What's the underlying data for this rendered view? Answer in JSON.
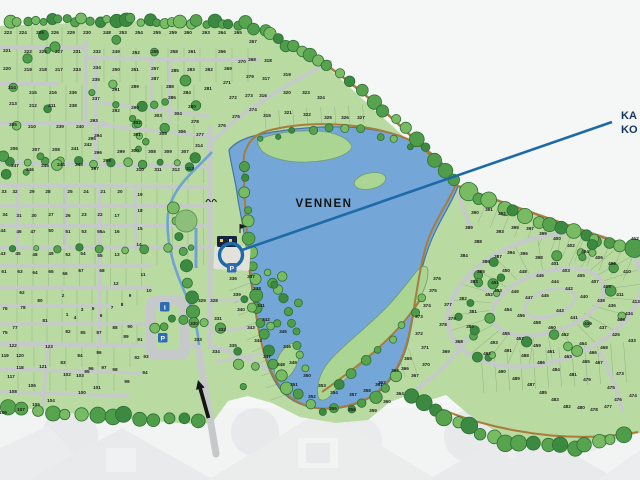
{
  "labels": {
    "lake": "VENNEN",
    "callout_line1": "KA",
    "callout_line2": "KO"
  },
  "icons": {
    "parking": "P",
    "info": "i"
  },
  "colors": {
    "bg": "#f5f6f6",
    "land": "#b9dba2",
    "island": "#abd593",
    "lake": "#74a7d8",
    "lake_edge": "#46749f",
    "road": "#c6c9ca",
    "path": "#a87c3c",
    "tree_dark": "#3c8a41",
    "tree_mid": "#57a34e",
    "tree_light": "#79bb63",
    "tree_edge": "#2d7034",
    "callout_line": "#1d6aa6",
    "navy_text": "#14365e",
    "badge_blue": "#2d6cb5",
    "number_text": "#1d1d1d",
    "photo": "#e3e6e7"
  },
  "plots": [
    [
      "223",
      8,
      34
    ],
    [
      "224",
      23,
      34
    ],
    [
      "225",
      40,
      34
    ],
    [
      "226",
      55,
      34
    ],
    [
      "229",
      71,
      34
    ],
    [
      "230",
      87,
      34
    ],
    [
      "248",
      107,
      34
    ],
    [
      "253",
      123,
      34
    ],
    [
      "254",
      139,
      34
    ],
    [
      "255",
      157,
      34
    ],
    [
      "259",
      173,
      34
    ],
    [
      "260",
      188,
      34
    ],
    [
      "263",
      206,
      34
    ],
    [
      "264",
      222,
      34
    ],
    [
      "265",
      238,
      34
    ],
    [
      "221",
      7,
      52
    ],
    [
      "222",
      28,
      53
    ],
    [
      "226",
      43,
      53
    ],
    [
      "227",
      59,
      53
    ],
    [
      "231",
      77,
      53
    ],
    [
      "232",
      97,
      53
    ],
    [
      "249",
      116,
      53
    ],
    [
      "252",
      136,
      54
    ],
    [
      "256",
      155,
      53
    ],
    [
      "258",
      174,
      53
    ],
    [
      "261",
      192,
      53
    ],
    [
      "266",
      222,
      53
    ],
    [
      "267",
      253,
      43
    ],
    [
      "268",
      252,
      61
    ],
    [
      "318",
      268,
      62
    ],
    [
      "220",
      7,
      70
    ],
    [
      "219",
      28,
      71
    ],
    [
      "218",
      43,
      71
    ],
    [
      "217",
      59,
      71
    ],
    [
      "233",
      77,
      71
    ],
    [
      "234",
      97,
      69
    ],
    [
      "250",
      116,
      71
    ],
    [
      "251",
      135,
      71
    ],
    [
      "257",
      155,
      70
    ],
    [
      "285",
      175,
      72
    ],
    [
      "283",
      191,
      71
    ],
    [
      "282",
      209,
      71
    ],
    [
      "269",
      228,
      70
    ],
    [
      "270",
      242,
      63
    ],
    [
      "279",
      250,
      78
    ],
    [
      "317",
      266,
      80
    ],
    [
      "319",
      287,
      76
    ],
    [
      "214",
      12,
      89
    ],
    [
      "215",
      33,
      94
    ],
    [
      "216",
      53,
      94
    ],
    [
      "236",
      73,
      94
    ],
    [
      "235",
      96,
      81
    ],
    [
      "291",
      116,
      91
    ],
    [
      "289",
      135,
      88
    ],
    [
      "287",
      155,
      80
    ],
    [
      "288",
      170,
      88
    ],
    [
      "284",
      187,
      94
    ],
    [
      "281",
      208,
      90
    ],
    [
      "271",
      227,
      84
    ],
    [
      "272",
      233,
      99
    ],
    [
      "273",
      249,
      97
    ],
    [
      "316",
      263,
      97
    ],
    [
      "320",
      287,
      94
    ],
    [
      "323",
      306,
      94
    ],
    [
      "324",
      321,
      99
    ],
    [
      "213",
      13,
      105
    ],
    [
      "212",
      33,
      107
    ],
    [
      "211",
      52,
      107
    ],
    [
      "238",
      73,
      107
    ],
    [
      "237",
      96,
      100
    ],
    [
      "292",
      116,
      112
    ],
    [
      "290",
      135,
      109
    ],
    [
      "286",
      172,
      99
    ],
    [
      "302",
      137,
      124
    ],
    [
      "303",
      158,
      117
    ],
    [
      "304",
      178,
      115
    ],
    [
      "280",
      192,
      108
    ],
    [
      "278",
      195,
      123
    ],
    [
      "274",
      253,
      111
    ],
    [
      "275",
      236,
      118
    ],
    [
      "276",
      222,
      127
    ],
    [
      "315",
      267,
      117
    ],
    [
      "321",
      288,
      114
    ],
    [
      "322",
      307,
      116
    ],
    [
      "325",
      328,
      119
    ],
    [
      "326",
      345,
      119
    ],
    [
      "327",
      361,
      119
    ],
    [
      "205",
      13,
      126
    ],
    [
      "210",
      32,
      128
    ],
    [
      "239",
      60,
      128
    ],
    [
      "240",
      80,
      128
    ],
    [
      "293",
      94,
      122
    ],
    [
      "294",
      98,
      137
    ],
    [
      "301",
      137,
      136
    ],
    [
      "305",
      163,
      135
    ],
    [
      "306",
      182,
      133
    ],
    [
      "277",
      200,
      136
    ],
    [
      "206",
      14,
      150
    ],
    [
      "207",
      36,
      151
    ],
    [
      "208",
      56,
      151
    ],
    [
      "241",
      75,
      150
    ],
    [
      "242",
      88,
      146
    ],
    [
      "296",
      98,
      154
    ],
    [
      "295",
      92,
      140
    ],
    [
      "299",
      121,
      153
    ],
    [
      "300",
      135,
      152
    ],
    [
      "308",
      152,
      153
    ],
    [
      "309",
      168,
      153
    ],
    [
      "307",
      185,
      153
    ],
    [
      "314",
      199,
      147
    ],
    [
      "247",
      15,
      167
    ],
    [
      "246",
      30,
      171
    ],
    [
      "245",
      45,
      167
    ],
    [
      "244",
      61,
      166
    ],
    [
      "243",
      79,
      166
    ],
    [
      "297",
      95,
      170
    ],
    [
      "298",
      107,
      162
    ],
    [
      "310",
      140,
      171
    ],
    [
      "311",
      158,
      171
    ],
    [
      "312",
      176,
      171
    ],
    [
      "313",
      190,
      170
    ],
    [
      "33",
      4,
      193
    ],
    [
      "32",
      15,
      193
    ],
    [
      "29",
      32,
      193
    ],
    [
      "28",
      48,
      193
    ],
    [
      "25",
      70,
      193
    ],
    [
      "24",
      86,
      193
    ],
    [
      "21",
      103,
      193
    ],
    [
      "20",
      120,
      193
    ],
    [
      "19",
      140,
      196
    ],
    [
      "34",
      5,
      216
    ],
    [
      "31",
      19,
      217
    ],
    [
      "30",
      34,
      217
    ],
    [
      "27",
      51,
      216
    ],
    [
      "26",
      68,
      217
    ],
    [
      "23",
      84,
      216
    ],
    [
      "22",
      100,
      216
    ],
    [
      "17",
      117,
      217
    ],
    [
      "18",
      140,
      212
    ],
    [
      "44",
      3,
      232
    ],
    [
      "46",
      19,
      233
    ],
    [
      "47",
      33,
      233
    ],
    [
      "50",
      51,
      232
    ],
    [
      "51",
      68,
      233
    ],
    [
      "53",
      84,
      233
    ],
    [
      "55a",
      101,
      233
    ],
    [
      "16",
      117,
      233
    ],
    [
      "15",
      140,
      230
    ],
    [
      "43",
      3,
      255
    ],
    [
      "45",
      18,
      255
    ],
    [
      "48",
      35,
      256
    ],
    [
      "49",
      51,
      255
    ],
    [
      "52",
      68,
      256
    ],
    [
      "54",
      83,
      255
    ],
    [
      "55",
      100,
      257
    ],
    [
      "13",
      117,
      256
    ],
    [
      "14",
      139,
      246
    ],
    [
      "61",
      4,
      273
    ],
    [
      "63",
      20,
      273
    ],
    [
      "64",
      35,
      274
    ],
    [
      "65",
      51,
      273
    ],
    [
      "66",
      65,
      275
    ],
    [
      "67",
      81,
      272
    ],
    [
      "68",
      102,
      272
    ],
    [
      "12",
      116,
      285
    ],
    [
      "11",
      143,
      276
    ],
    [
      "10",
      149,
      292
    ],
    [
      "62",
      22,
      294
    ],
    [
      "2",
      63,
      297
    ],
    [
      "80",
      40,
      302
    ],
    [
      "9",
      130,
      297
    ],
    [
      "8",
      122,
      306
    ],
    [
      "76",
      5,
      310
    ],
    [
      "78",
      23,
      309
    ],
    [
      "1",
      67,
      316
    ],
    [
      "3",
      82,
      311
    ],
    [
      "5",
      93,
      310
    ],
    [
      "4",
      75,
      319
    ],
    [
      "6",
      101,
      317
    ],
    [
      "7",
      112,
      309
    ],
    [
      "81",
      45,
      322
    ],
    [
      "77",
      15,
      329
    ],
    [
      "75",
      5,
      334
    ],
    [
      "82",
      68,
      333
    ],
    [
      "85",
      83,
      334
    ],
    [
      "87",
      99,
      334
    ],
    [
      "88",
      115,
      329
    ],
    [
      "90",
      130,
      328
    ],
    [
      "91",
      140,
      341
    ],
    [
      "89",
      126,
      338
    ],
    [
      "122",
      13,
      347
    ],
    [
      "123",
      49,
      348
    ],
    [
      "119",
      5,
      357
    ],
    [
      "120",
      20,
      357
    ],
    [
      "118",
      20,
      369
    ],
    [
      "121",
      43,
      368
    ],
    [
      "117",
      11,
      378
    ],
    [
      "86",
      99,
      354
    ],
    [
      "84",
      80,
      357
    ],
    [
      "83",
      63,
      364
    ],
    [
      "96",
      91,
      370
    ],
    [
      "97",
      104,
      369
    ],
    [
      "92",
      137,
      359
    ],
    [
      "93",
      146,
      358
    ],
    [
      "95",
      87,
      373
    ],
    [
      "94",
      145,
      374
    ],
    [
      "98",
      115,
      371
    ],
    [
      "99",
      127,
      383
    ],
    [
      "100",
      82,
      394
    ],
    [
      "101",
      97,
      389
    ],
    [
      "102",
      67,
      376
    ],
    [
      "103",
      80,
      377
    ],
    [
      "104",
      51,
      402
    ],
    [
      "105",
      36,
      406
    ],
    [
      "106",
      32,
      387
    ],
    [
      "107",
      21,
      411
    ],
    [
      "108",
      13,
      393
    ],
    [
      "109",
      3,
      414
    ],
    [
      "336",
      233,
      280
    ],
    [
      "337",
      251,
      278
    ],
    [
      "338",
      257,
      290
    ],
    [
      "339",
      237,
      296
    ],
    [
      "329",
      202,
      302
    ],
    [
      "328",
      214,
      302
    ],
    [
      "330",
      194,
      325
    ],
    [
      "331",
      218,
      320
    ],
    [
      "332",
      222,
      331
    ],
    [
      "333",
      198,
      341
    ],
    [
      "334",
      216,
      353
    ],
    [
      "335",
      233,
      347
    ],
    [
      "340",
      241,
      311
    ],
    [
      "341",
      261,
      307
    ],
    [
      "342",
      266,
      321
    ],
    [
      "343",
      251,
      329
    ],
    [
      "344",
      258,
      342
    ],
    [
      "345",
      283,
      333
    ],
    [
      "346",
      287,
      348
    ],
    [
      "347",
      267,
      358
    ],
    [
      "348",
      281,
      366
    ],
    [
      "349",
      293,
      364
    ],
    [
      "350",
      307,
      377
    ],
    [
      "351",
      294,
      386
    ],
    [
      "352",
      312,
      398
    ],
    [
      "353",
      322,
      387
    ],
    [
      "354",
      334,
      394
    ],
    [
      "355",
      333,
      410
    ],
    [
      "356",
      352,
      411
    ],
    [
      "357",
      353,
      396
    ],
    [
      "358",
      367,
      392
    ],
    [
      "359",
      373,
      412
    ],
    [
      "360",
      387,
      403
    ],
    [
      "361",
      379,
      386
    ],
    [
      "362",
      382,
      384
    ],
    [
      "363",
      395,
      372
    ],
    [
      "364",
      400,
      395
    ],
    [
      "365",
      408,
      360
    ],
    [
      "366",
      405,
      370
    ],
    [
      "367",
      415,
      377
    ],
    [
      "368",
      459,
      343
    ],
    [
      "369",
      446,
      353
    ],
    [
      "370",
      426,
      366
    ],
    [
      "371",
      425,
      349
    ],
    [
      "372",
      419,
      335
    ],
    [
      "373",
      419,
      318
    ],
    [
      "374",
      427,
      307
    ],
    [
      "375",
      433,
      292
    ],
    [
      "376",
      437,
      280
    ],
    [
      "377",
      448,
      306
    ],
    [
      "378",
      443,
      326
    ],
    [
      "379",
      452,
      320
    ],
    [
      "380",
      470,
      328
    ],
    [
      "381",
      473,
      313
    ],
    [
      "382",
      463,
      300
    ],
    [
      "383",
      474,
      283
    ],
    [
      "384",
      464,
      257
    ],
    [
      "385",
      481,
      273
    ],
    [
      "386",
      486,
      263
    ],
    [
      "387",
      498,
      258
    ],
    [
      "388",
      478,
      243
    ],
    [
      "389",
      469,
      229
    ],
    [
      "390",
      475,
      214
    ],
    [
      "391",
      489,
      211
    ],
    [
      "392",
      502,
      215
    ],
    [
      "393",
      500,
      233
    ],
    [
      "394",
      511,
      254
    ],
    [
      "395",
      515,
      229
    ],
    [
      "396",
      524,
      255
    ],
    [
      "397",
      530,
      230
    ],
    [
      "398",
      539,
      259
    ],
    [
      "399",
      543,
      235
    ],
    [
      "400",
      557,
      240
    ],
    [
      "401",
      555,
      265
    ],
    [
      "402",
      571,
      247
    ],
    [
      "403",
      566,
      272
    ],
    [
      "404",
      585,
      253
    ],
    [
      "405",
      581,
      277
    ],
    [
      "406",
      599,
      259
    ],
    [
      "407",
      595,
      283
    ],
    [
      "408",
      612,
      265
    ],
    [
      "409",
      607,
      288
    ],
    [
      "410",
      627,
      273
    ],
    [
      "411",
      620,
      296
    ],
    [
      "412",
      635,
      240
    ],
    [
      "413",
      636,
      303
    ],
    [
      "425",
      616,
      336
    ],
    [
      "433",
      632,
      342
    ],
    [
      "434",
      629,
      315
    ],
    [
      "435",
      621,
      321
    ],
    [
      "436",
      612,
      307
    ],
    [
      "437",
      603,
      329
    ],
    [
      "438",
      601,
      302
    ],
    [
      "439",
      588,
      325
    ],
    [
      "440",
      584,
      298
    ],
    [
      "441",
      574,
      319
    ],
    [
      "442",
      569,
      290
    ],
    [
      "443",
      560,
      312
    ],
    [
      "444",
      555,
      283
    ],
    [
      "445",
      545,
      297
    ],
    [
      "446",
      540,
      277
    ],
    [
      "447",
      529,
      299
    ],
    [
      "448",
      523,
      273
    ],
    [
      "449",
      515,
      293
    ],
    [
      "450",
      506,
      272
    ],
    [
      "451",
      495,
      284
    ],
    [
      "452",
      489,
      296
    ],
    [
      "453",
      498,
      292
    ],
    [
      "454",
      508,
      311
    ],
    [
      "456",
      521,
      317
    ],
    [
      "458",
      537,
      324
    ],
    [
      "460",
      552,
      329
    ],
    [
      "462",
      565,
      336
    ],
    [
      "464",
      583,
      345
    ],
    [
      "466",
      593,
      354
    ],
    [
      "468",
      604,
      349
    ],
    [
      "455",
      506,
      335
    ],
    [
      "457",
      520,
      340
    ],
    [
      "459",
      537,
      347
    ],
    [
      "461",
      551,
      353
    ],
    [
      "463",
      568,
      358
    ],
    [
      "465",
      586,
      363
    ],
    [
      "467",
      599,
      364
    ],
    [
      "484",
      556,
      371
    ],
    [
      "486",
      541,
      364
    ],
    [
      "488",
      525,
      357
    ],
    [
      "490",
      502,
      373
    ],
    [
      "491",
      508,
      352
    ],
    [
      "492",
      487,
      355
    ],
    [
      "493",
      494,
      344
    ],
    [
      "487",
      531,
      386
    ],
    [
      "485",
      543,
      394
    ],
    [
      "489",
      516,
      380
    ],
    [
      "483",
      555,
      401
    ],
    [
      "482",
      567,
      408
    ],
    [
      "481",
      573,
      376
    ],
    [
      "480",
      581,
      409
    ],
    [
      "479",
      587,
      381
    ],
    [
      "478",
      594,
      411
    ],
    [
      "477",
      608,
      408
    ],
    [
      "476",
      618,
      401
    ],
    [
      "475",
      611,
      389
    ],
    [
      "474",
      633,
      397
    ],
    [
      "473",
      620,
      375
    ]
  ]
}
